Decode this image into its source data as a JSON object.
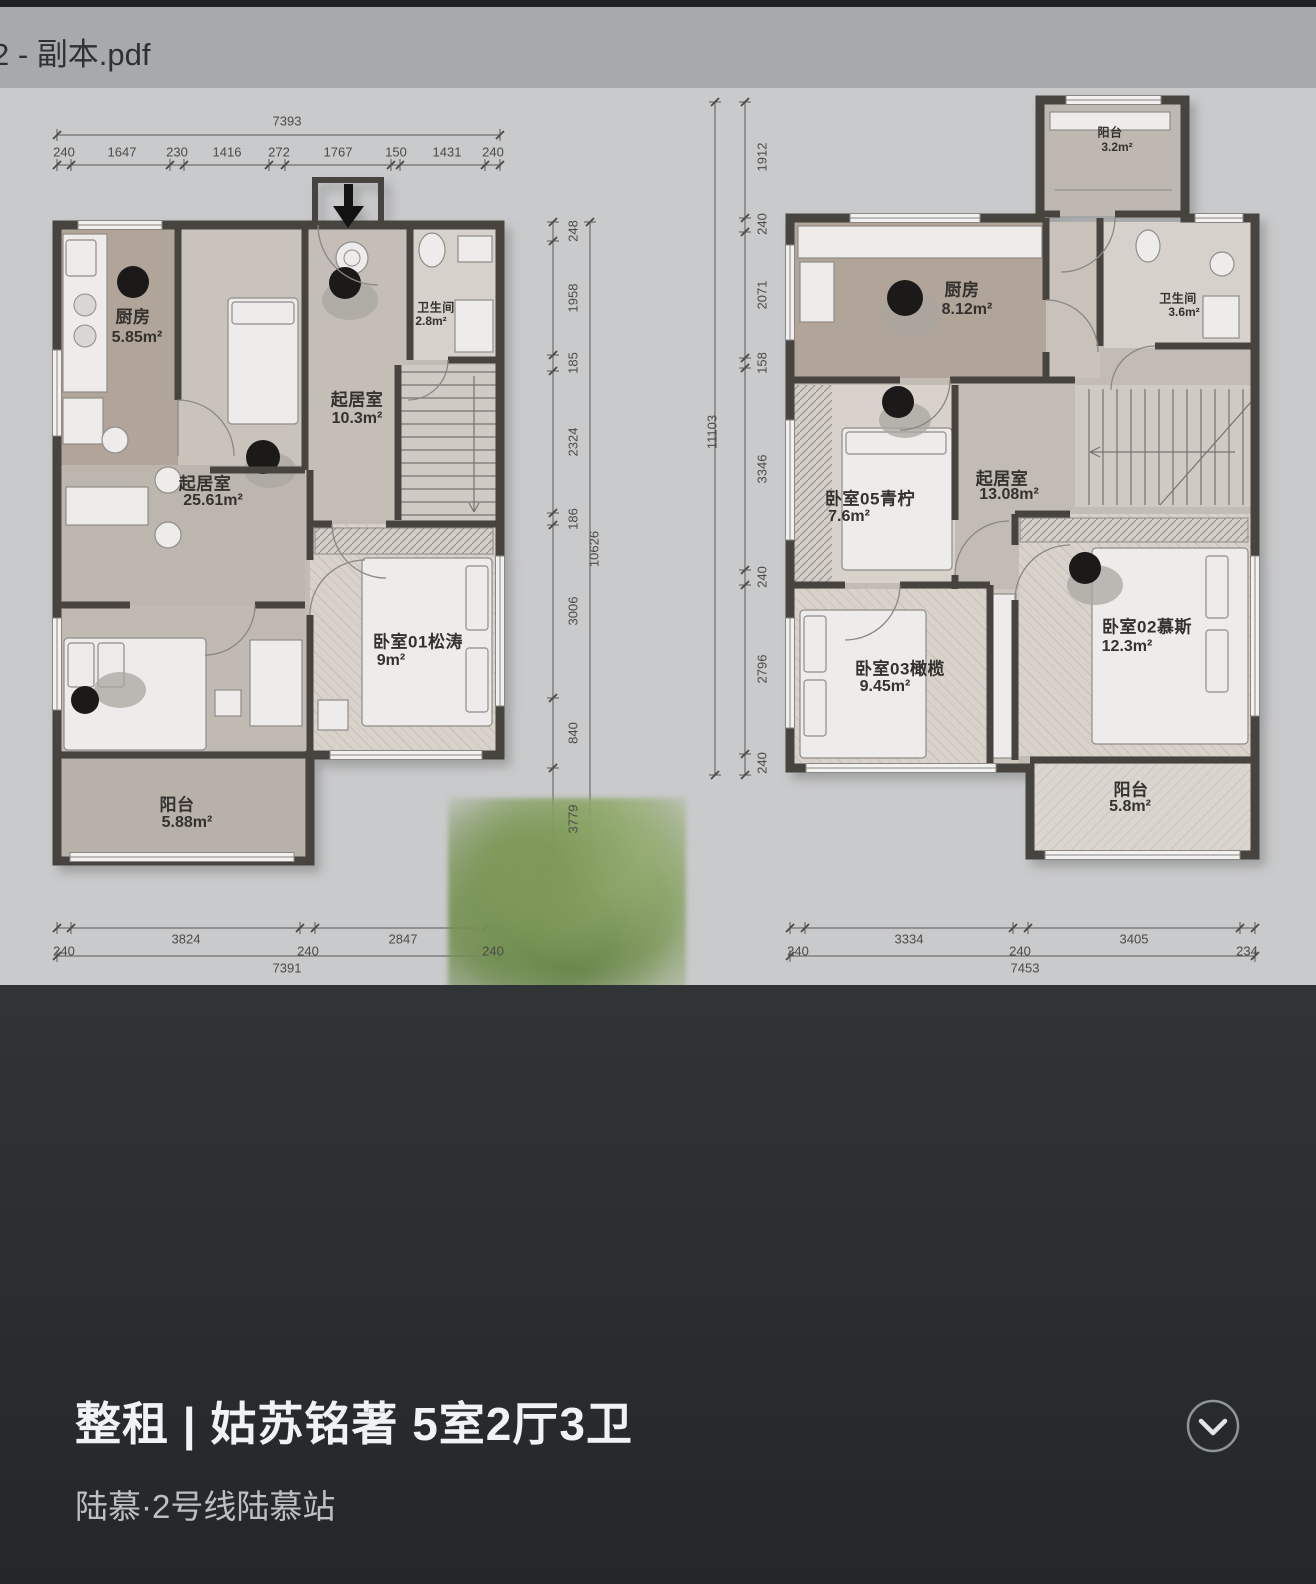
{
  "header": {
    "filename": "2 - 副本.pdf"
  },
  "listing": {
    "title": "整租 | 姑苏铭著 5室2厅3卫",
    "subtitle": "陆慕·2号线陆慕站",
    "expand_icon": "chevron-down"
  },
  "colors": {
    "accent_dark_panel": "#2b2f31",
    "pdf_header": "#a7a9ac",
    "page_bg": "#c9cacb",
    "wall": "#474440"
  },
  "plans": [
    {
      "name": "floor-plan-1",
      "rooms": [
        {
          "label": "厨房",
          "area": "5.85m²"
        },
        {
          "label": "起居室",
          "area": "10.3m²"
        },
        {
          "label": "卫生间",
          "area": "2.8m²"
        },
        {
          "label": "起居室",
          "area": "25.61m²"
        },
        {
          "label": "卧室01松涛",
          "area": "9m²"
        },
        {
          "label": "阳台",
          "area": "5.88m²"
        }
      ],
      "dims": {
        "top_total": "7393",
        "top": [
          "240",
          "1647",
          "230",
          "1416",
          "272",
          "1767",
          "150",
          "1431",
          "240"
        ],
        "right": [
          "248",
          "1958",
          "185",
          "2324",
          "186",
          "3006",
          "840",
          "3779"
        ],
        "right_total": "10626",
        "bottom": [
          "240",
          "3824",
          "240",
          "2847",
          "240"
        ],
        "bottom_total": "7391"
      }
    },
    {
      "name": "floor-plan-2",
      "rooms": [
        {
          "label": "阳台",
          "area": "3.2m²"
        },
        {
          "label": "厨房",
          "area": "8.12m²"
        },
        {
          "label": "卫生间",
          "area": "3.6m²"
        },
        {
          "label": "卧室05青柠",
          "area": "7.6m²"
        },
        {
          "label": "起居室",
          "area": "13.08m²"
        },
        {
          "label": "卧室02慕斯",
          "area": "12.3m²"
        },
        {
          "label": "卧室03橄榄",
          "area": "9.45m²"
        },
        {
          "label": "阳台",
          "area": "5.8m²"
        }
      ],
      "dims": {
        "left": [
          "1912",
          "240",
          "2071",
          "158",
          "3346",
          "240",
          "2796",
          "240"
        ],
        "left_total": "11103",
        "bottom": [
          "240",
          "3334",
          "240",
          "3405",
          "234"
        ],
        "bottom_total": "7453"
      }
    }
  ]
}
